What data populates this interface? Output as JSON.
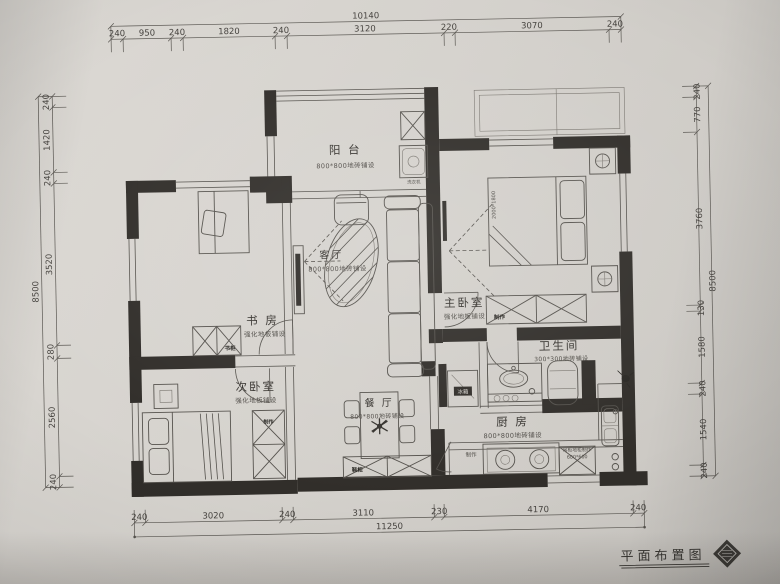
{
  "photo": {
    "title": "平面布置图"
  },
  "dims": {
    "top": {
      "total": "10140",
      "segs": [
        "240",
        "950",
        "240",
        "1820",
        "240",
        "3120",
        "220",
        "3070",
        "240"
      ]
    },
    "bottom": {
      "total": "11250",
      "segs": [
        "240",
        "3020",
        "240",
        "3110",
        "230",
        "4170",
        "240"
      ]
    },
    "left": {
      "total": "8500",
      "segs": [
        "240",
        "1420",
        "240",
        "3520",
        "280",
        "2560",
        "240"
      ]
    },
    "right": {
      "total": "8500",
      "segs": [
        "240",
        "770",
        "3760",
        "130",
        "1580",
        "240",
        "1540",
        "240"
      ]
    }
  },
  "rooms": {
    "balcony": {
      "name": "阳 台",
      "floor": "800*800地砖铺设"
    },
    "living": {
      "name": "客厅",
      "floor": "800*800地砖铺设"
    },
    "master": {
      "name": "主卧室",
      "floor": "强化地板铺设"
    },
    "study": {
      "name": "书 房",
      "floor": "强化地板铺设"
    },
    "bedroom2": {
      "name": "次卧室",
      "floor": "强化地板铺设"
    },
    "dining": {
      "name": "餐 厅",
      "floor": "800*800地砖铺设"
    },
    "kitchen": {
      "name": "厨 房",
      "floor": "800*800地砖铺设"
    },
    "bath": {
      "name": "卫生间",
      "floor": "300*300地砖铺设"
    }
  },
  "labels": {
    "bed_size": "2000*1800",
    "master_wardrobe": "制作",
    "bed2_wardrobe": "制作",
    "bookcase": "书柜",
    "shoe_cabinet": "鞋柜",
    "fridge": "冰箱",
    "washer": "洗衣机",
    "counter": "制作",
    "base_cabinet": "吊柜地柜制作",
    "base_cabinet_size": "600*600"
  }
}
